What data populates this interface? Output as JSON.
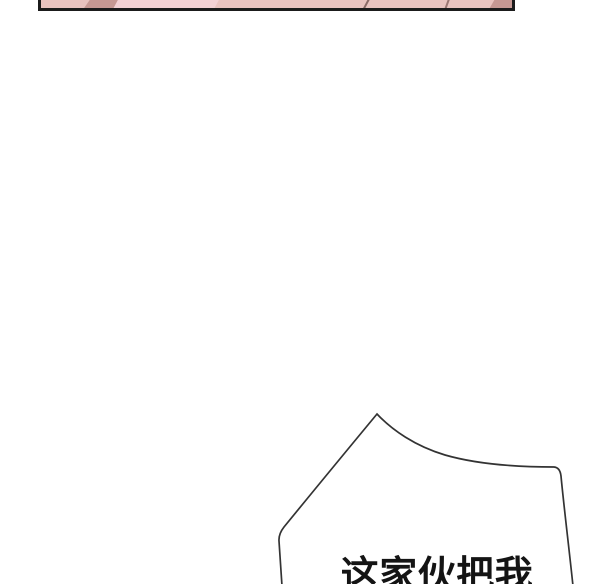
{
  "page": {
    "kind": "webtoon-comic-page",
    "background_color": "#ffffff"
  },
  "top_panel": {
    "description": "bottom sliver of a comic panel cut off by the top edge",
    "border_color": "#1b1b1b",
    "base_color": "#e9c3bf",
    "light_color": "#f3d1d4",
    "shade_color": "#c69893"
  },
  "speech_bubble": {
    "text": "这家伙把我",
    "stroke_color": "#333333",
    "fill_color": "#ffffff",
    "text_color": "#141414"
  }
}
